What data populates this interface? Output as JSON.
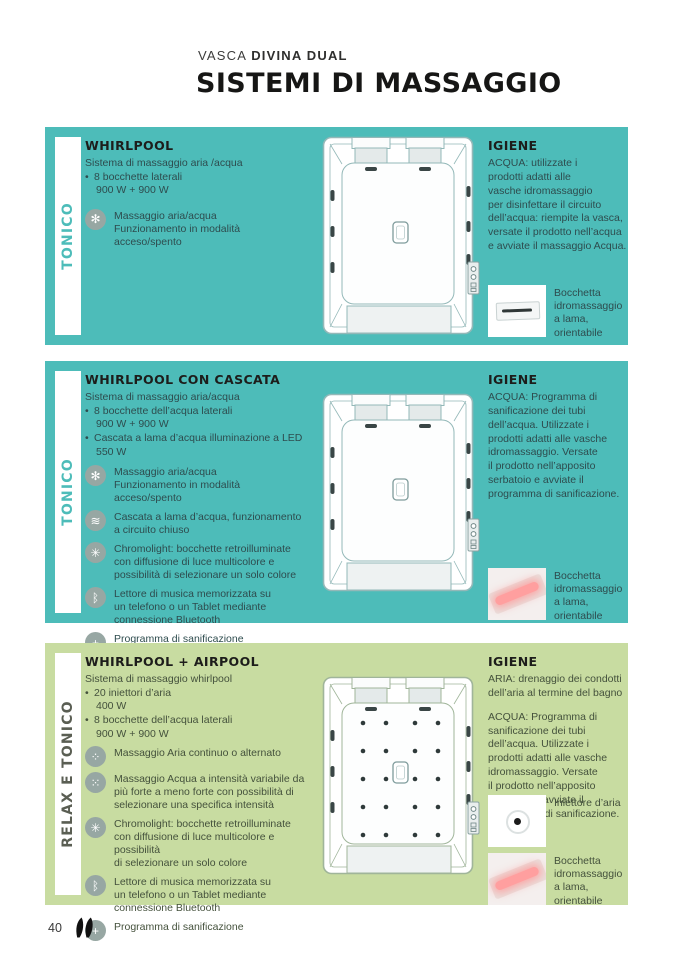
{
  "header": {
    "collection_prefix": "VASCA ",
    "collection_model": "DIVINA DUAL",
    "title": "SISTEMI DI MASSAGGIO"
  },
  "colors": {
    "teal": "#4dbcb9",
    "green": "#c8dca1",
    "icon_gray": "#97a7a3",
    "heading_text": "#1d1d1b",
    "side_label_green": "#5a5e53",
    "nozzle_glow_pink": "#ff9f9f"
  },
  "sections": [
    {
      "theme": "teal",
      "side_label": "TONICO",
      "title": "WHIRLPOOL",
      "intro": "Sistema di massaggio aria /acqua",
      "specs": [
        {
          "line1": "8 bocchette laterali",
          "line2": "900 W + 900 W"
        }
      ],
      "features": [
        {
          "icon": "air-water-massage-icon",
          "glyph": "✻",
          "text": "Massaggio aria/acqua\nFunzionamento in modalità\nacceso/spento"
        }
      ],
      "diagram": {
        "air_injectors": false
      },
      "hygiene": {
        "title": "IGIENE",
        "paragraphs": [
          "ACQUA: utilizzate i\nprodotti adatti alle\nvasche idromassaggio\nper disinfettare il circuito\ndell’acqua: riempite la vasca,\nversate il prodotto nell’acqua\ne avviate il massaggio Acqua."
        ],
        "items": [
          {
            "photo": "water-jet-nozzle-photo",
            "type": "nozzle-white",
            "caption": "Bocchetta\nidromassaggio\na lama,\norientabile"
          }
        ]
      }
    },
    {
      "theme": "teal",
      "side_label": "TONICO",
      "title": "WHIRLPOOL CON CASCATA",
      "intro": "Sistema di massaggio aria/acqua",
      "specs": [
        {
          "line1": "8 bocchette dell’acqua laterali",
          "line2": "900 W + 900 W"
        },
        {
          "line1": "Cascata a lama d’acqua illuminazione a LED",
          "line2": "550 W"
        }
      ],
      "features": [
        {
          "icon": "air-water-massage-icon",
          "glyph": "✻",
          "text": "Massaggio aria/acqua\nFunzionamento in modalità\nacceso/spento"
        },
        {
          "icon": "cascade-icon",
          "glyph": "≋",
          "text": "Cascata a lama d’acqua, funzionamento\na circuito chiuso"
        },
        {
          "icon": "chromolight-icon",
          "glyph": "✳",
          "text": "Chromolight: bocchette retroilluminate\ncon diffusione di luce multicolore e\npossibilità di selezionare un solo colore"
        },
        {
          "icon": "bluetooth-music-icon",
          "glyph": "ᛒ",
          "text": "Lettore di musica memorizzata su\nun telefono o un Tablet mediante\nconnessione Bluetooth"
        },
        {
          "icon": "sanitization-icon",
          "glyph": "+",
          "text": "Programma di sanificazione"
        }
      ],
      "diagram": {
        "air_injectors": false
      },
      "hygiene": {
        "title": "IGIENE",
        "paragraphs": [
          "ACQUA: Programma di\nsanificazione dei tubi\ndell’acqua. Utilizzate i\nprodotti adatti alle vasche\nidromassaggio. Versate\nil prodotto nell’apposito\nserbatoio e avviate il\nprogramma di sanificazione."
        ],
        "items": [
          {
            "photo": "led-water-jet-nozzle-photo",
            "type": "nozzle-pink",
            "caption": "Bocchetta\nidromassaggio\na lama,\norientabile"
          }
        ]
      }
    },
    {
      "theme": "green",
      "side_label": "RELAX E TONICO",
      "title": "WHIRLPOOL + AIRPOOL",
      "intro": "Sistema di massaggio whirlpool",
      "specs": [
        {
          "line1": "20 iniettori d’aria",
          "line2": "400 W"
        },
        {
          "line1": "8 bocchette dell’acqua laterali",
          "line2": "900 W + 900 W"
        }
      ],
      "features": [
        {
          "icon": "air-massage-icon",
          "glyph": "⁘",
          "text": "Massaggio Aria continuo o alternato"
        },
        {
          "icon": "water-massage-icon",
          "glyph": "⁙",
          "text": "Massaggio Acqua a intensità variabile da\npiù forte a meno forte con possibilità di\nselezionare una specifica intensità"
        },
        {
          "icon": "chromolight-icon",
          "glyph": "✳",
          "text": "Chromolight: bocchette retroilluminate\ncon diffusione di luce multicolore e\npossibilità\ndi selezionare un solo colore"
        },
        {
          "icon": "bluetooth-music-icon",
          "glyph": "ᛒ",
          "text": "Lettore di musica memorizzata su\nun telefono o un Tablet mediante\nconnessione Bluetooth"
        },
        {
          "icon": "sanitization-icon",
          "glyph": "+",
          "text": "Programma di sanificazione"
        }
      ],
      "diagram": {
        "air_injectors": true
      },
      "hygiene": {
        "title": "IGIENE",
        "paragraphs": [
          "ARIA: drenaggio dei condotti\ndell’aria al termine del bagno",
          "ACQUA: Programma di\nsanificazione dei tubi\ndell’acqua. Utilizzate i\nprodotti adatti alle vasche\nidromassaggio. Versate\nil prodotto nell’apposito\nserbatoio e avviate il\nprogramma di sanificazione."
        ],
        "items": [
          {
            "photo": "air-injector-photo",
            "type": "air-injector",
            "caption": "Iniettore d’aria"
          },
          {
            "photo": "led-water-jet-nozzle-photo",
            "type": "nozzle-pink",
            "caption": "Bocchetta\nidromassaggio\na lama,\norientabile"
          }
        ]
      }
    }
  ],
  "footer": {
    "page_number": "40"
  }
}
